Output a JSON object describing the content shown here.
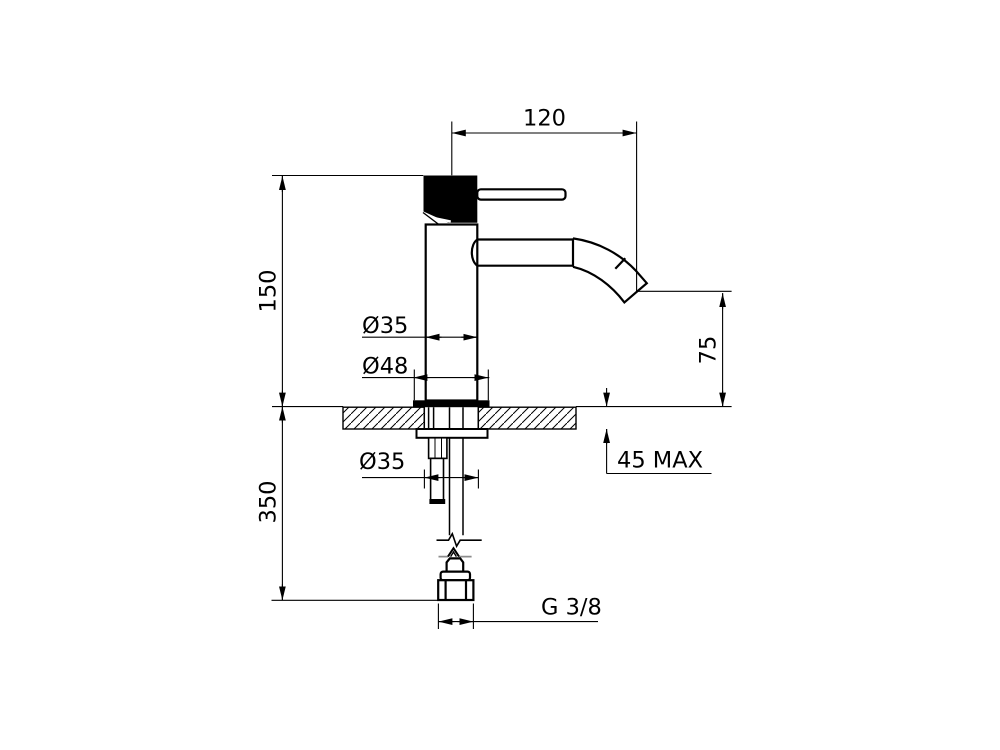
{
  "drawing": {
    "colors": {
      "line": "#000000",
      "background": "#ffffff",
      "handle_fill": "#000000"
    },
    "labels": {
      "spout_reach": "120",
      "height_above_deck": "150",
      "body_diameter": "Ø35",
      "base_diameter": "Ø48",
      "spout_height": "75",
      "deck_thickness_max": "45 MAX",
      "below_deck_length": "350",
      "shank_diameter": "Ø35",
      "thread_size": "G 3/8"
    }
  }
}
